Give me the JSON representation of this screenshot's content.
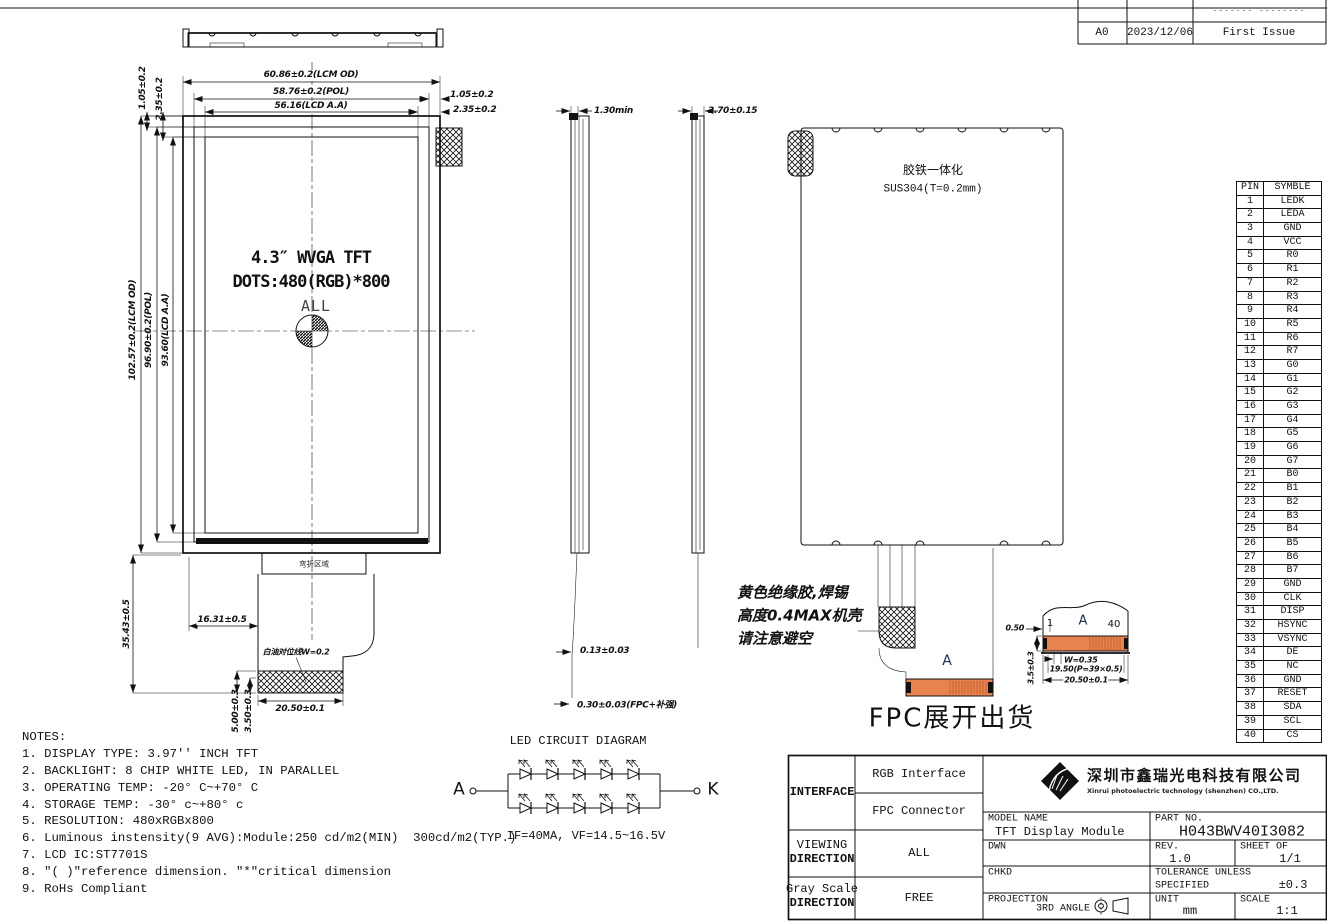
{
  "revision": {
    "modification_dashes": "------- --------",
    "rev": "A0",
    "date": "2023/12/06",
    "description": "First Issue"
  },
  "front_view": {
    "title_line1": "4.3″ WVGA TFT",
    "title_line2": "DOTS:480(RGB)*800",
    "viewing_area_label": "ALL",
    "bend_area_label": "弯折区域",
    "white_line_note": "白油对位线W=0.2",
    "dims": {
      "lcm_width": "60.86±0.2(LCM OD)",
      "pol_width": "58.76±0.2(POL)",
      "aa_width": "56.16(LCD A.A)",
      "right_inset_1": "1.05±0.2",
      "right_inset_2": "2.35±0.2",
      "top_inset_1": "1.05±0.2",
      "top_inset_2": "2.35±0.2",
      "lcm_height": "102.57±0.2(LCM OD)",
      "pol_height": "96.90±0.2(POL)",
      "aa_height": "93.60(LCD A.A)",
      "fpc_length": "35.43±0.5",
      "fpc_left_offset": "16.31±0.5",
      "fpc_end_width": "20.50±0.1",
      "stiffener_h1": "5.00±0.3",
      "stiffener_h2": "3.50±0.3"
    }
  },
  "side_view_left": {
    "dims": {
      "top": "1.30min",
      "fpc_thickness": "0.13±0.03",
      "fpc_stiffener": "0.30±0.03(FPC+补强)"
    }
  },
  "side_view_right": {
    "dims": {
      "top": "2.70±0.15"
    }
  },
  "back_view": {
    "material_note_1": "胶铁一体化",
    "material_note_2": "SUS304(T=0.2mm)",
    "solder_note_1": "黄色绝缘胶,焊锡",
    "solder_note_2": "高度0.4MAX机壳",
    "solder_note_3": "请注意避空",
    "section_label": "A",
    "fpc_ship_note": "FPC展开出货"
  },
  "detail_a": {
    "pin_first": "1",
    "section_label": "A",
    "pin_last": "40",
    "dims": {
      "edge_gap": "0.50",
      "height": "3.5±0.3",
      "pad_width": "W=0.35",
      "pitch": "19.50(P=39×0.5)",
      "total_width": "20.50±0.1"
    }
  },
  "pin_table": {
    "headers": [
      "PIN",
      "SYMBLE"
    ],
    "rows": [
      [
        "1",
        "LEDK"
      ],
      [
        "2",
        "LEDA"
      ],
      [
        "3",
        "GND"
      ],
      [
        "4",
        "VCC"
      ],
      [
        "5",
        "R0"
      ],
      [
        "6",
        "R1"
      ],
      [
        "7",
        "R2"
      ],
      [
        "8",
        "R3"
      ],
      [
        "9",
        "R4"
      ],
      [
        "10",
        "R5"
      ],
      [
        "11",
        "R6"
      ],
      [
        "12",
        "R7"
      ],
      [
        "13",
        "G0"
      ],
      [
        "14",
        "G1"
      ],
      [
        "15",
        "G2"
      ],
      [
        "16",
        "G3"
      ],
      [
        "17",
        "G4"
      ],
      [
        "18",
        "G5"
      ],
      [
        "19",
        "G6"
      ],
      [
        "20",
        "G7"
      ],
      [
        "21",
        "B0"
      ],
      [
        "22",
        "B1"
      ],
      [
        "23",
        "B2"
      ],
      [
        "24",
        "B3"
      ],
      [
        "25",
        "B4"
      ],
      [
        "26",
        "B5"
      ],
      [
        "27",
        "B6"
      ],
      [
        "28",
        "B7"
      ],
      [
        "29",
        "GND"
      ],
      [
        "30",
        "CLK"
      ],
      [
        "31",
        "DISP"
      ],
      [
        "32",
        "HSYNC"
      ],
      [
        "33",
        "VSYNC"
      ],
      [
        "34",
        "DE"
      ],
      [
        "35",
        "NC"
      ],
      [
        "36",
        "GND"
      ],
      [
        "37",
        "RESET"
      ],
      [
        "38",
        "SDA"
      ],
      [
        "39",
        "SCL"
      ],
      [
        "40",
        "CS"
      ]
    ]
  },
  "notes": {
    "title": "NOTES:",
    "items": [
      "1. DISPLAY TYPE: 3.97'' INCH TFT",
      "2. BACKLIGHT: 8 CHIP WHITE LED, IN PARALLEL",
      "3. OPERATING TEMP: -20° C~+70° C",
      "4. STORAGE TEMP: -30° c~+80° c",
      "5. RESOLUTION: 480xRGBx800",
      "6. Luminous instensity(9 AVG):Module:250 cd/m2(MIN)  300cd/m2(TYP.)",
      "7. LCD IC:ST7701S",
      "8. \"( )\"reference dimension. \"*\"critical dimension",
      "9. RoHs Compliant"
    ]
  },
  "led_diagram": {
    "title": "LED CIRCUIT DIAGRAM",
    "anode_label": "A",
    "cathode_label": "K",
    "spec": "IF=40MA, VF=14.5~16.5V"
  },
  "title_block": {
    "interface_label": "INTERFACE",
    "interface_1": "RGB Interface",
    "interface_2": "FPC Connector",
    "viewing_label_1": "VIEWING",
    "viewing_label_2": "DIRECTION",
    "viewing_value": "ALL",
    "grayscale_label_1": "Gray Scale",
    "grayscale_label_2": "DIRECTION",
    "grayscale_value": "FREE",
    "company_cn": "深圳市鑫瑞光电科技有限公司",
    "company_en": "Xinrui photoelectric technology (shenzhen) CO.,LTD.",
    "model_label": "MODEL NAME",
    "model_value": "TFT Display Module",
    "part_label": "PART NO.",
    "part_value": "H043BWV40I3082",
    "dwn_label": "DWN",
    "rev_label": "REV.",
    "rev_value": "1.0",
    "sheet_label": "SHEET OF",
    "sheet_value": "1/1",
    "chkd_label": "CHKD",
    "tol_label_1": "TOLERANCE UNLESS",
    "tol_label_2": "SPECIFIED",
    "tol_value": "±0.3",
    "proj_label": "PROJECTION",
    "proj_value": "3RD ANGLE",
    "unit_label": "UNIT",
    "unit_value": "mm",
    "scale_label": "SCALE",
    "scale_value": "1:1"
  },
  "colors": {
    "line": "#111111",
    "fpc_connector_orange": "#E8824E",
    "background": "#ffffff"
  }
}
